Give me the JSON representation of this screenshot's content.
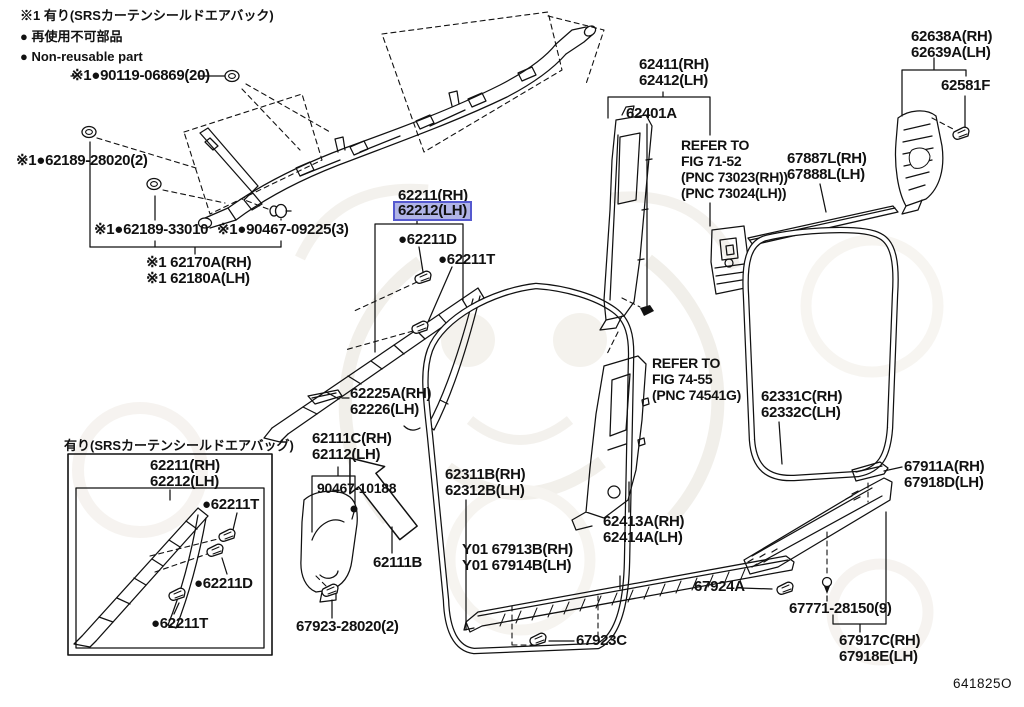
{
  "diagram": {
    "code": "641825O",
    "type": "parts-catalog-figure",
    "highlight_fill": "#b0b4e6",
    "highlight_border": "#5559cf",
    "line_color": "#111111",
    "background": "#ffffff"
  },
  "legend": {
    "srs_note": "※1 有り(SRSカーテンシールドエアバック)",
    "non_reusable_jp": "● 再使用不可部品",
    "non_reusable_en": "● Non-reusable part"
  },
  "labels": {
    "l90119": [
      "※1●90119-06869(20)"
    ],
    "l62189_28020": [
      "※1●62189-28020(2)"
    ],
    "l62189_33010": [
      "※1●62189-33010"
    ],
    "l90467_09225": [
      "※1●90467-09225(3)"
    ],
    "l62170": [
      "※1 62170A(RH)",
      "※1 62180A(LH)"
    ],
    "l62211": [
      "62211(RH)"
    ],
    "l62212": [
      "62212(LH)"
    ],
    "l62211d": [
      "●62211D"
    ],
    "l62211t": [
      "●62211T"
    ],
    "l62225": [
      "62225A(RH)",
      "62226(LH)"
    ],
    "l62111c": [
      "62111C(RH)",
      "62112(LH)"
    ],
    "l90467_10188": [
      "90467-10188"
    ],
    "l62311b": [
      "62311B(RH)",
      "62312B(LH)"
    ],
    "l62111b": [
      "62111B"
    ],
    "l67923_28020": [
      "67923-28020(2)"
    ],
    "ly01": [
      "Y01 67913B(RH)",
      "Y01 67914B(LH)"
    ],
    "l67923c": [
      "67923C"
    ],
    "l62411": [
      "62411(RH)",
      "62412(LH)"
    ],
    "l62401a": [
      "62401A"
    ],
    "refer1": [
      "REFER TO",
      "FIG 71-52",
      "(PNC 73023(RH))",
      "(PNC 73024(LH))"
    ],
    "l67887l": [
      "67887L(RH)",
      "67888L(LH)"
    ],
    "l62638a": [
      "62638A(RH)",
      "62639A(LH)"
    ],
    "l62581f": [
      "62581F"
    ],
    "refer2": [
      "REFER TO",
      "FIG 74-55",
      "(PNC 74541G)"
    ],
    "l62331c": [
      "62331C(RH)",
      "62332C(LH)"
    ],
    "l62413a": [
      "62413A(RH)",
      "62414A(LH)"
    ],
    "l67911a": [
      "67911A(RH)",
      "67918D(LH)"
    ],
    "l67924a": [
      "67924A"
    ],
    "l67771": [
      "67771-28150(9)"
    ],
    "l67917c": [
      "67917C(RH)",
      "67918E(LH)"
    ]
  },
  "inset": {
    "title": "有り(SRSカーテンシールドエアバッグ)",
    "part": [
      "62211(RH)",
      "62212(LH)"
    ],
    "clip_top": "●62211T",
    "clip_mid": "●62211D",
    "clip_bottom": "●62211T"
  }
}
